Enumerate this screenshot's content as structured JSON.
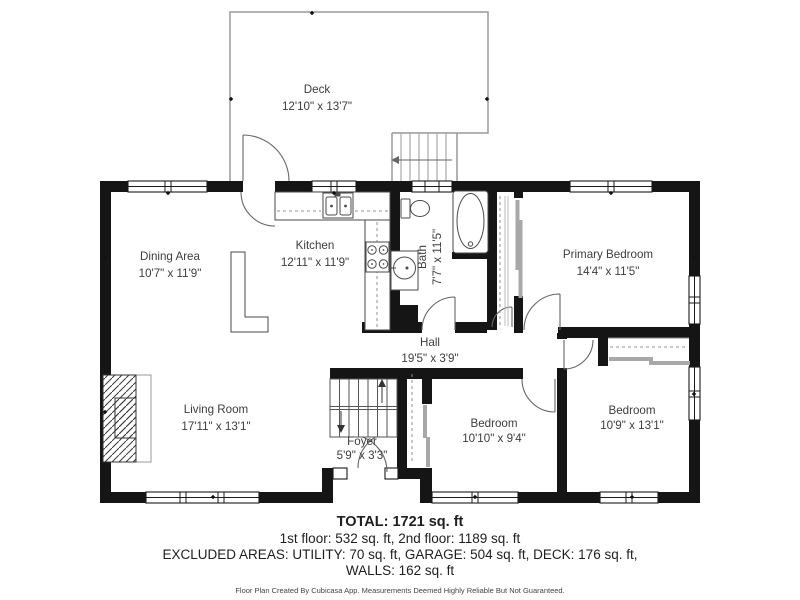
{
  "rooms": [
    {
      "name": "Deck",
      "dims": "12'10\" x 13'7\""
    },
    {
      "name": "Dining Area",
      "dims": "10'7\" x 11'9\""
    },
    {
      "name": "Kitchen",
      "dims": "12'11\" x 11'9\""
    },
    {
      "name": "Bath",
      "dims": "7'7\" x 11'5\""
    },
    {
      "name": "Primary Bedroom",
      "dims": "14'4\" x 11'5\""
    },
    {
      "name": "Hall",
      "dims": "19'5\" x 3'9\""
    },
    {
      "name": "Living Room",
      "dims": "17'11\" x 13'1\""
    },
    {
      "name": "Foyer",
      "dims": "5'9\" x 3'3\""
    },
    {
      "name": "Bedroom",
      "dims": "10'10\" x 9'4\""
    },
    {
      "name": "Bedroom",
      "dims": "10'9\" x 13'1\""
    }
  ],
  "summary": {
    "total": "TOTAL: 1721 sq. ft",
    "floors": "1st floor: 532 sq. ft, 2nd floor: 1189 sq. ft",
    "excluded": "EXCLUDED AREAS: UTILITY: 70 sq. ft, GARAGE: 504 sq. ft, DECK: 176 sq. ft,",
    "walls": "WALLS: 162 sq. ft",
    "disclaimer": "Floor Plan Created By Cubicasa App. Measurements Deemed Highly Reliable But Not Guaranteed."
  },
  "colors": {
    "wall": "#151515",
    "fixture_line": "#4a4a4a",
    "deck_line": "#999999",
    "label_text": "#3d3d3d",
    "sliding_door": "#a8a8a8"
  }
}
